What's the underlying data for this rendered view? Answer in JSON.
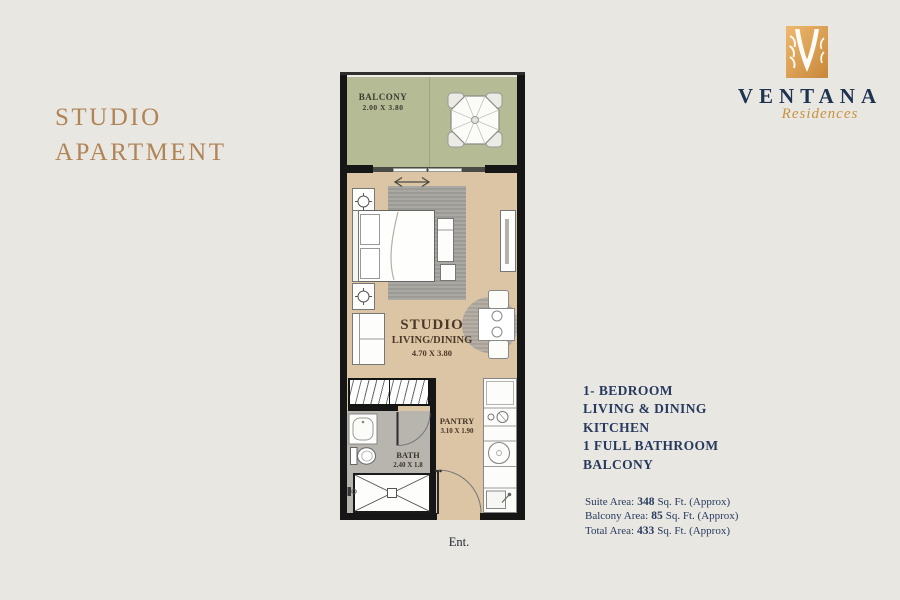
{
  "header": {
    "title_line1": "STUDIO",
    "title_line2": "APARTMENT"
  },
  "logo": {
    "brand": "VENTANA",
    "sub": "Residences",
    "emblem": "ventana-v-emblem"
  },
  "plan": {
    "balcony": {
      "name": "BALCONY",
      "dims": "2.00 X 3.80"
    },
    "living": {
      "name1": "STUDIO",
      "name2": "LIVING/DINING",
      "dims": "4.70 X 3.80"
    },
    "pantry": {
      "name": "PANTRY",
      "dims": "3.10 X 1.90"
    },
    "bath": {
      "name": "BATH",
      "dims": "2.40 X 1.8"
    },
    "entrance": "Ent."
  },
  "features": [
    "1- BEDROOM",
    "LIVING & DINING",
    "KITCHEN",
    "1 FULL BATHROOM",
    "BALCONY"
  ],
  "areas": [
    {
      "label": "Suite Area:",
      "value": "348",
      "suffix": "Sq. Ft. (Approx)"
    },
    {
      "label": "Balcony Area:",
      "value": "85",
      "suffix": "Sq. Ft. (Approx)"
    },
    {
      "label": "Total Area:",
      "value": "433",
      "suffix": "Sq. Ft. (Approx)"
    }
  ],
  "colors": {
    "background": "#e9e7e2",
    "title_gold": "#b08457",
    "navy_text": "#273a5e",
    "script_gold": "#c9923f",
    "floor_tan": "#dcc5a4",
    "balcony_green": "#b5bb95",
    "bath_gray": "#b8b5af",
    "wall_black": "#161616"
  }
}
